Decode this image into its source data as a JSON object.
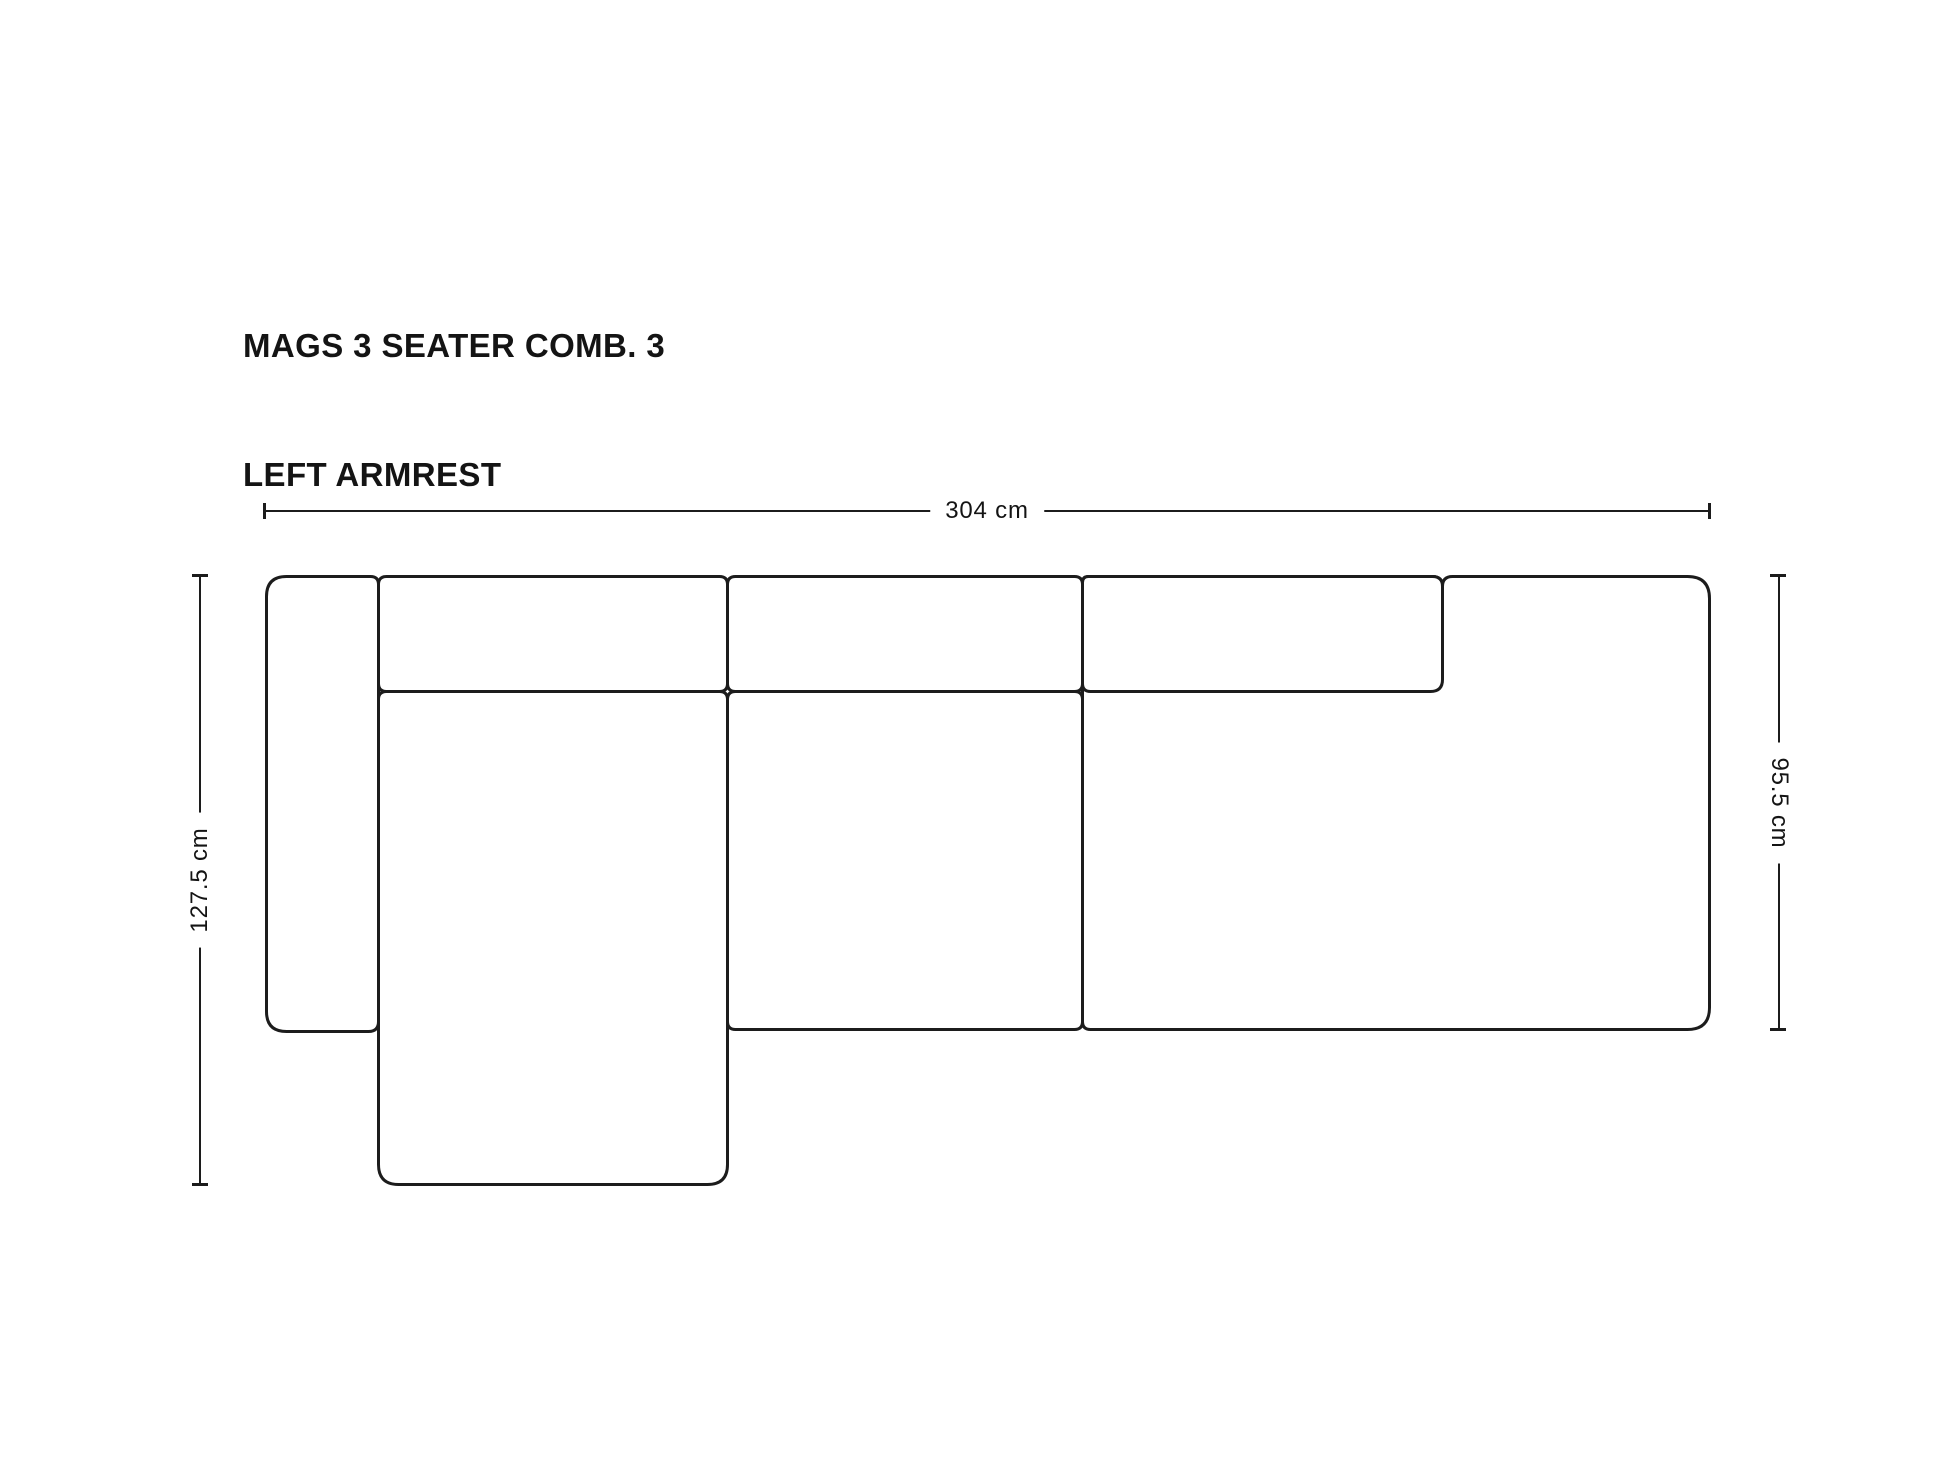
{
  "title": {
    "line1": "MAGS 3 SEATER COMB. 3",
    "line2": "LEFT ARMREST"
  },
  "dimensions": {
    "width": {
      "label": "304 cm"
    },
    "depth_left": {
      "label": "127.5 cm"
    },
    "depth_right": {
      "label": "95.5 cm"
    }
  },
  "colors": {
    "line": "#1c1c1c",
    "text": "#141414",
    "background": "#ffffff"
  },
  "sofa": {
    "description": "Top view outline drawing of sofa combination",
    "modules": [
      {
        "name": "left-armrest"
      },
      {
        "name": "back-cushion-left"
      },
      {
        "name": "back-cushion-middle"
      },
      {
        "name": "back-cushion-right"
      },
      {
        "name": "chaise-longue-seat"
      },
      {
        "name": "middle-seat"
      },
      {
        "name": "right-corner-module"
      }
    ]
  }
}
